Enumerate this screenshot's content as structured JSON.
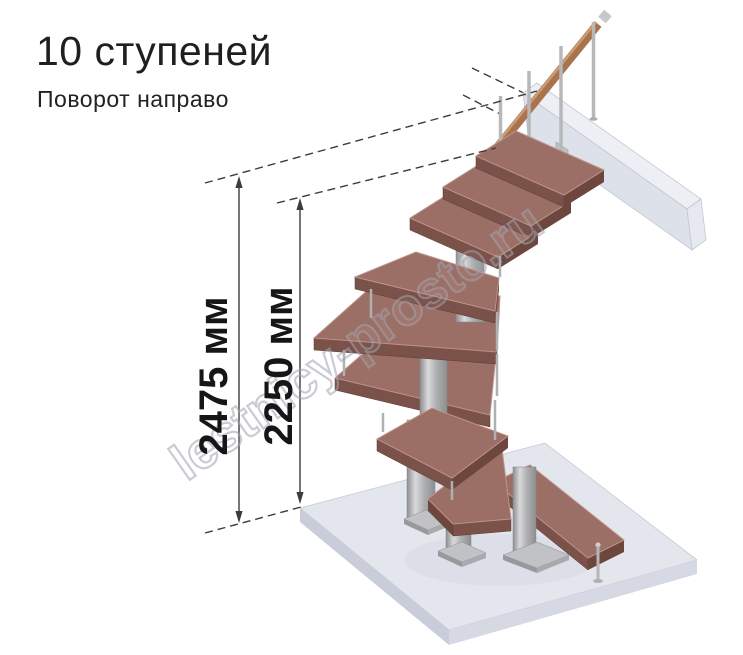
{
  "header": {
    "title": "10 ступеней",
    "subtitle": "Поворот направо"
  },
  "dimensions": {
    "total": {
      "label": "2475 мм",
      "value": 2475,
      "unit": "мм"
    },
    "to_top_step": {
      "label": "2250 мм",
      "value": 2250,
      "unit": "мм"
    }
  },
  "watermark": {
    "text": "lestnicy-prosto.ru"
  },
  "render": {
    "steps_count": 10,
    "turn_direction": "направо",
    "colors": {
      "tread_top": "#9c6f66",
      "tread_front": "#7a524a",
      "tread_side": "#6d463e",
      "tread_edge": "#bd948a",
      "metal_light": "#dadadc",
      "metal_mid": "#aeb0b2",
      "metal_dark": "#8e8e90",
      "handrail": "#a9744d",
      "handrail_light": "#cfa57c",
      "slab_top": "#e4e6ee",
      "slab_front": "#c9cdda",
      "slab_side": "#d6d9e4",
      "beam_top": "#edeff5",
      "beam_front": "#dde1ea",
      "beam_end": "#e6e9f0",
      "plate": "#c0c2c6",
      "dimension_line": "#3c3c3c",
      "text": "#1f1f1f",
      "watermark": "#b9bac2"
    }
  }
}
